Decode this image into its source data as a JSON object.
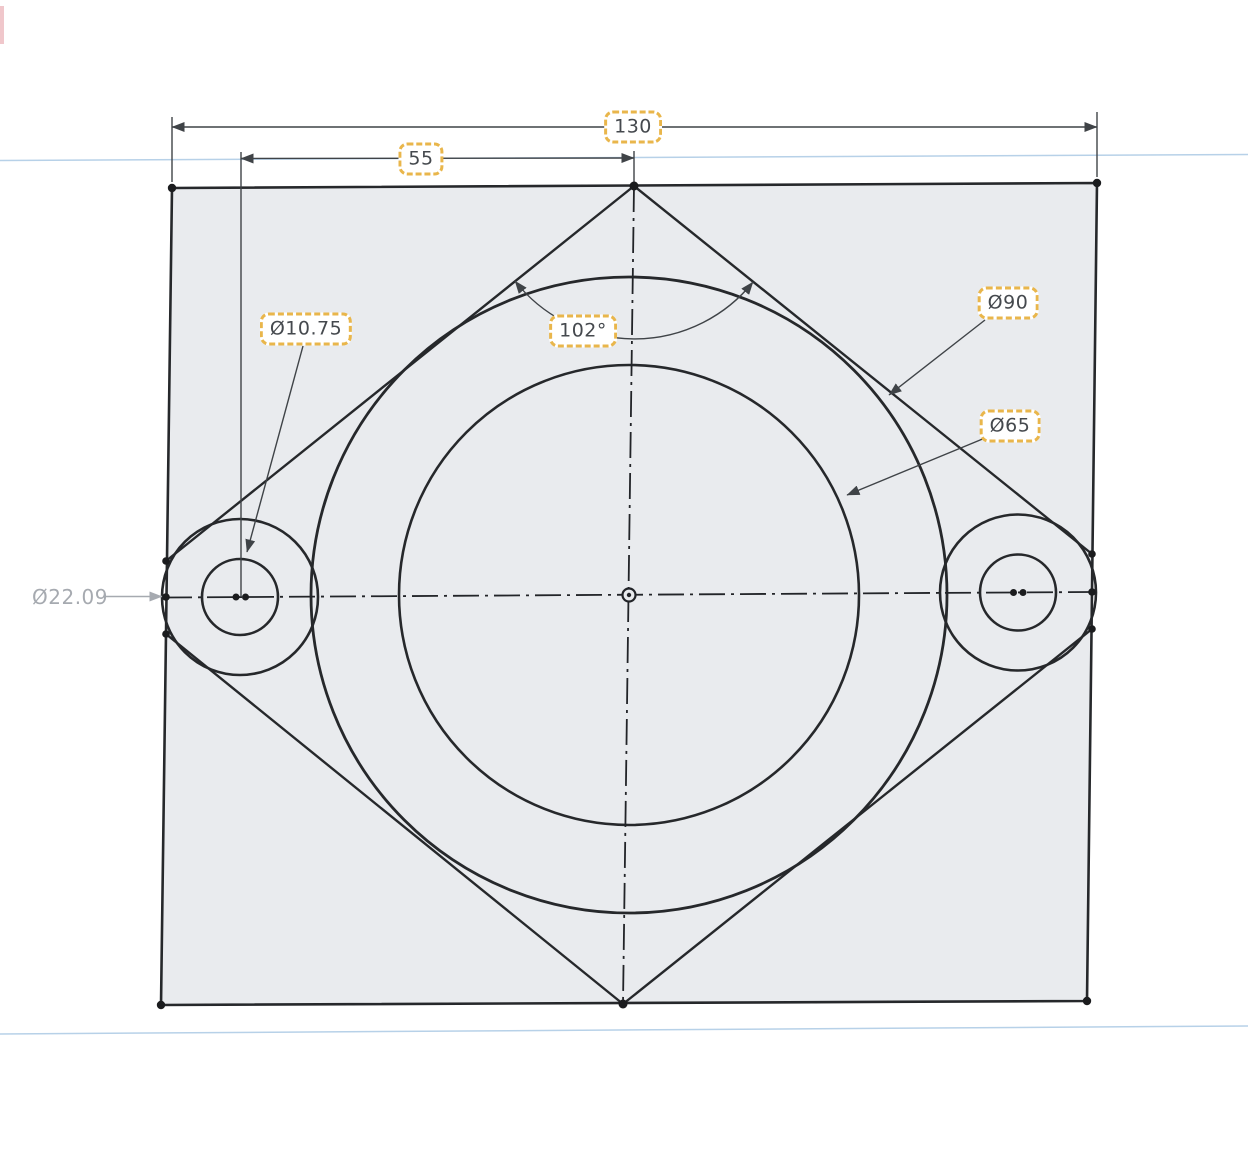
{
  "app_context": "cad-sketch-canvas",
  "dims": {
    "width": {
      "label": "130",
      "value": 130,
      "type": "linear",
      "highlighted": true
    },
    "offset": {
      "label": "55",
      "value": 55,
      "type": "linear",
      "highlighted": true
    },
    "angle": {
      "label": "102°",
      "value": 102,
      "type": "angular",
      "highlighted": true
    },
    "hole": {
      "label": "Ø10.75",
      "value": 10.75,
      "type": "diameter",
      "highlighted": true
    },
    "outer": {
      "label": "Ø90",
      "value": 90,
      "type": "diameter",
      "highlighted": true
    },
    "bore": {
      "label": "Ø65",
      "value": 65,
      "type": "diameter",
      "highlighted": true
    },
    "boss": {
      "label": "Ø22.09",
      "value": 22.09,
      "type": "diameter",
      "highlighted": false
    }
  },
  "colors": {
    "sheet_fill": "#e9ebee",
    "sketch_line": "#26282b",
    "dimension_line": "#3f4347",
    "construction_line": "#b7d1e8",
    "highlight_box_border": "#e9b64b",
    "label_text": "#45494e",
    "reference_dim": "#a6aab0",
    "page_background": "#ffffff"
  }
}
